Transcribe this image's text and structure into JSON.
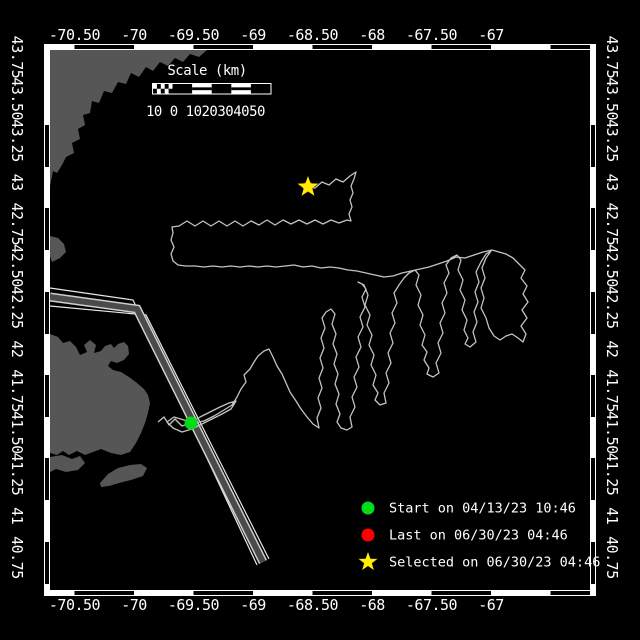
{
  "colors": {
    "background": "#000000",
    "land": "#565656",
    "track": "#c3c3c3",
    "frame": "#ffffff",
    "lane_band": "#4a4a4a",
    "lane_line": "#e8e8e8",
    "start_marker": "#00dd16",
    "last_marker": "#ff0000",
    "selected_marker": "#ffee00"
  },
  "axes": {
    "top_labels": [
      {
        "text": "-70.50",
        "x": 74.5
      },
      {
        "text": "-70",
        "x": 134
      },
      {
        "text": "-69.50",
        "x": 193.5
      },
      {
        "text": "-69",
        "x": 253
      },
      {
        "text": "-68.50",
        "x": 312.5
      },
      {
        "text": "-68",
        "x": 372
      },
      {
        "text": "-67.50",
        "x": 431.5
      },
      {
        "text": "-67",
        "x": 491
      }
    ],
    "side_labels": [
      {
        "text": "43.75",
        "y": 57
      },
      {
        "text": "43.50",
        "y": 98.7
      },
      {
        "text": "43.25",
        "y": 140.4
      },
      {
        "text": "43",
        "y": 182.1
      },
      {
        "text": "42.75",
        "y": 223.8
      },
      {
        "text": "42.50",
        "y": 265.5
      },
      {
        "text": "42.25",
        "y": 307.2
      },
      {
        "text": "42",
        "y": 348.9
      },
      {
        "text": "41.75",
        "y": 390.6
      },
      {
        "text": "41.50",
        "y": 432.3
      },
      {
        "text": "41.25",
        "y": 474
      },
      {
        "text": "41",
        "y": 515.7
      },
      {
        "text": "40.75",
        "y": 557.4
      }
    ],
    "top_baseline_y": 40,
    "bottom_baseline_y": 610,
    "left_anchor_x": 17,
    "right_anchor_x": 612
  },
  "frame": {
    "outer": [
      44,
      44,
      552,
      552
    ],
    "inner": [
      50,
      50,
      540,
      540
    ],
    "black_segments_x": [
      [
        74.5,
        134
      ],
      [
        193.5,
        253
      ],
      [
        312.5,
        372
      ],
      [
        431.5,
        491
      ],
      [
        550.5,
        590
      ]
    ],
    "black_segments_y": [
      [
        125,
        167
      ],
      [
        208,
        250
      ],
      [
        292,
        334
      ],
      [
        375,
        417
      ],
      [
        458,
        500
      ],
      [
        542,
        584
      ]
    ]
  },
  "scale_bar": {
    "title": "Scale (km)",
    "title_x": 207,
    "title_y": 75,
    "numbers": "10 0 1020304050",
    "numbers_x": 146,
    "numbers_y": 116,
    "bar": {
      "x": 153,
      "y": 84,
      "w": 117.5,
      "h": 9.5,
      "checker_w": 19.5,
      "segments": 5
    }
  },
  "legend": {
    "marker_x": 368,
    "text_x": 389,
    "rows_y": [
      508,
      535,
      562
    ],
    "items": [
      {
        "marker": "circle",
        "color": "#00dd16",
        "label": "Start on 04/13/23 10:46"
      },
      {
        "marker": "circle",
        "color": "#ff0000",
        "label": "Last on 06/30/23 04:46"
      },
      {
        "marker": "star",
        "color": "#ffee00",
        "label": "Selected on 06/30/23 04:46"
      }
    ]
  },
  "markers": {
    "start": {
      "x": 191,
      "y": 423,
      "r": 6.5
    },
    "last": {
      "x": 308,
      "y": 187,
      "r": 5.5
    },
    "selected": {
      "x": 308,
      "y": 187,
      "r_outer": 11,
      "r_inner": 4.4
    }
  },
  "land_polygons": [
    [
      [
        50,
        50
      ],
      [
        207,
        50
      ],
      [
        199,
        57
      ],
      [
        190,
        54
      ],
      [
        183,
        62
      ],
      [
        175,
        58
      ],
      [
        168,
        66
      ],
      [
        160,
        62
      ],
      [
        153,
        71
      ],
      [
        146,
        67
      ],
      [
        139,
        77
      ],
      [
        131,
        73
      ],
      [
        126,
        84
      ],
      [
        118,
        82
      ],
      [
        112,
        93
      ],
      [
        104,
        91
      ],
      [
        99,
        103
      ],
      [
        92,
        101
      ],
      [
        90,
        113
      ],
      [
        83,
        115
      ],
      [
        85,
        125
      ],
      [
        78,
        129
      ],
      [
        80,
        139
      ],
      [
        72,
        143
      ],
      [
        74,
        153
      ],
      [
        66,
        157
      ],
      [
        62,
        165
      ],
      [
        57,
        173
      ],
      [
        53,
        171
      ],
      [
        51,
        181
      ],
      [
        50,
        186
      ]
    ],
    [
      [
        50,
        236
      ],
      [
        58,
        238
      ],
      [
        64,
        244
      ],
      [
        66,
        252
      ],
      [
        60,
        258
      ],
      [
        52,
        262
      ],
      [
        50,
        256
      ]
    ],
    [
      [
        50,
        334
      ],
      [
        58,
        337
      ],
      [
        63,
        343
      ],
      [
        70,
        341
      ],
      [
        76,
        347
      ],
      [
        80,
        355
      ],
      [
        87,
        352
      ],
      [
        84,
        345
      ],
      [
        90,
        340
      ],
      [
        96,
        345
      ],
      [
        94,
        353
      ],
      [
        101,
        351
      ],
      [
        105,
        346
      ],
      [
        111,
        344
      ],
      [
        114,
        348
      ],
      [
        118,
        344
      ],
      [
        124,
        342
      ],
      [
        128,
        346
      ],
      [
        129,
        354
      ],
      [
        124,
        360
      ],
      [
        117,
        363
      ],
      [
        111,
        361
      ],
      [
        108,
        366
      ],
      [
        113,
        370
      ],
      [
        121,
        372
      ],
      [
        129,
        377
      ],
      [
        137,
        383
      ],
      [
        144,
        389
      ],
      [
        148,
        395
      ],
      [
        150,
        403
      ],
      [
        148,
        413
      ],
      [
        145,
        423
      ],
      [
        141,
        433
      ],
      [
        136,
        443
      ],
      [
        130,
        452
      ],
      [
        121,
        455
      ],
      [
        111,
        453
      ],
      [
        101,
        449
      ],
      [
        93,
        452
      ],
      [
        85,
        455
      ],
      [
        77,
        451
      ],
      [
        69,
        455
      ],
      [
        63,
        451
      ],
      [
        57,
        455
      ],
      [
        50,
        453
      ]
    ],
    [
      [
        50,
        457
      ],
      [
        62,
        455
      ],
      [
        72,
        459
      ],
      [
        80,
        456
      ],
      [
        85,
        463
      ],
      [
        78,
        470
      ],
      [
        66,
        472
      ],
      [
        56,
        469
      ],
      [
        50,
        472
      ]
    ],
    [
      [
        100,
        483
      ],
      [
        108,
        474
      ],
      [
        118,
        468
      ],
      [
        130,
        465
      ],
      [
        141,
        464
      ],
      [
        147,
        468
      ],
      [
        143,
        476
      ],
      [
        131,
        480
      ],
      [
        119,
        483
      ],
      [
        109,
        486
      ],
      [
        101,
        487
      ]
    ]
  ],
  "shipping_lane": {
    "west_line": [
      [
        50,
        288
      ],
      [
        133,
        300
      ],
      [
        257,
        565
      ]
    ],
    "center_band": [
      [
        50,
        297
      ],
      [
        137,
        309
      ],
      [
        263,
        562
      ]
    ],
    "east_line": [
      [
        50,
        306
      ],
      [
        146,
        315
      ],
      [
        269,
        559
      ]
    ],
    "band_width": 6,
    "edge_width": 9,
    "line_width": 1.2
  },
  "track_points": [
    [
      158,
      422
    ],
    [
      164,
      417
    ],
    [
      169,
      425
    ],
    [
      175,
      419
    ],
    [
      182,
      426
    ],
    [
      191,
      423
    ],
    [
      200,
      417
    ],
    [
      210,
      412
    ],
    [
      220,
      407
    ],
    [
      229,
      403
    ],
    [
      236,
      401
    ],
    [
      231,
      409
    ],
    [
      222,
      414
    ],
    [
      212,
      419
    ],
    [
      202,
      424
    ],
    [
      192,
      429
    ],
    [
      182,
      432
    ],
    [
      173,
      428
    ],
    [
      167,
      422
    ],
    [
      174,
      417
    ],
    [
      184,
      420
    ],
    [
      194,
      423
    ],
    [
      204,
      421
    ],
    [
      214,
      416
    ],
    [
      224,
      410
    ],
    [
      232,
      405
    ],
    [
      237,
      397
    ],
    [
      241,
      389
    ],
    [
      246,
      382
    ],
    [
      244,
      375
    ],
    [
      250,
      369
    ],
    [
      254,
      362
    ],
    [
      258,
      356
    ],
    [
      264,
      351
    ],
    [
      269,
      349
    ],
    [
      273,
      357
    ],
    [
      277,
      366
    ],
    [
      282,
      374
    ],
    [
      286,
      383
    ],
    [
      290,
      392
    ],
    [
      296,
      401
    ],
    [
      301,
      409
    ],
    [
      307,
      417
    ],
    [
      313,
      424
    ],
    [
      319,
      428
    ],
    [
      317,
      418
    ],
    [
      321,
      408
    ],
    [
      318,
      398
    ],
    [
      322,
      388
    ],
    [
      319,
      378
    ],
    [
      323,
      368
    ],
    [
      320,
      358
    ],
    [
      324,
      348
    ],
    [
      321,
      338
    ],
    [
      325,
      328
    ],
    [
      322,
      318
    ],
    [
      326,
      312
    ],
    [
      331,
      309
    ],
    [
      335,
      314
    ],
    [
      332,
      324
    ],
    [
      336,
      334
    ],
    [
      333,
      344
    ],
    [
      337,
      354
    ],
    [
      334,
      364
    ],
    [
      338,
      374
    ],
    [
      335,
      384
    ],
    [
      339,
      394
    ],
    [
      336,
      404
    ],
    [
      340,
      414
    ],
    [
      337,
      422
    ],
    [
      341,
      428
    ],
    [
      347,
      430
    ],
    [
      352,
      427
    ],
    [
      350,
      417
    ],
    [
      355,
      407
    ],
    [
      352,
      397
    ],
    [
      357,
      387
    ],
    [
      354,
      377
    ],
    [
      359,
      367
    ],
    [
      356,
      357
    ],
    [
      361,
      347
    ],
    [
      358,
      337
    ],
    [
      363,
      327
    ],
    [
      360,
      317
    ],
    [
      365,
      307
    ],
    [
      362,
      297
    ],
    [
      366,
      289
    ],
    [
      362,
      284
    ],
    [
      358,
      282
    ],
    [
      364,
      285
    ],
    [
      368,
      295
    ],
    [
      365,
      305
    ],
    [
      370,
      315
    ],
    [
      367,
      325
    ],
    [
      372,
      335
    ],
    [
      369,
      345
    ],
    [
      374,
      355
    ],
    [
      371,
      365
    ],
    [
      376,
      375
    ],
    [
      373,
      385
    ],
    [
      378,
      393
    ],
    [
      375,
      400
    ],
    [
      380,
      405
    ],
    [
      386,
      403
    ],
    [
      384,
      393
    ],
    [
      389,
      383
    ],
    [
      386,
      373
    ],
    [
      391,
      363
    ],
    [
      388,
      353
    ],
    [
      393,
      343
    ],
    [
      390,
      333
    ],
    [
      395,
      323
    ],
    [
      392,
      313
    ],
    [
      397,
      303
    ],
    [
      394,
      293
    ],
    [
      399,
      285
    ],
    [
      404,
      278
    ],
    [
      409,
      273
    ],
    [
      415,
      270
    ],
    [
      419,
      275
    ],
    [
      416,
      285
    ],
    [
      421,
      295
    ],
    [
      418,
      305
    ],
    [
      423,
      315
    ],
    [
      420,
      325
    ],
    [
      425,
      335
    ],
    [
      422,
      345
    ],
    [
      427,
      352
    ],
    [
      424,
      360
    ],
    [
      429,
      368
    ],
    [
      427,
      374
    ],
    [
      433,
      377
    ],
    [
      439,
      373
    ],
    [
      436,
      363
    ],
    [
      441,
      353
    ],
    [
      438,
      343
    ],
    [
      443,
      333
    ],
    [
      440,
      323
    ],
    [
      445,
      313
    ],
    [
      442,
      303
    ],
    [
      447,
      293
    ],
    [
      444,
      283
    ],
    [
      449,
      273
    ],
    [
      446,
      265
    ],
    [
      451,
      258
    ],
    [
      457,
      255
    ],
    [
      461,
      260
    ],
    [
      458,
      270
    ],
    [
      463,
      280
    ],
    [
      460,
      290
    ],
    [
      465,
      300
    ],
    [
      462,
      310
    ],
    [
      467,
      320
    ],
    [
      464,
      330
    ],
    [
      468,
      338
    ],
    [
      465,
      344
    ],
    [
      470,
      347
    ],
    [
      476,
      342
    ],
    [
      473,
      332
    ],
    [
      477,
      322
    ],
    [
      474,
      312
    ],
    [
      478,
      302
    ],
    [
      475,
      292
    ],
    [
      479,
      282
    ],
    [
      476,
      272
    ],
    [
      481,
      262
    ],
    [
      486,
      254
    ],
    [
      491,
      251
    ],
    [
      486,
      258
    ],
    [
      482,
      268
    ],
    [
      485,
      278
    ],
    [
      481,
      288
    ],
    [
      484,
      298
    ],
    [
      481,
      308
    ],
    [
      486,
      318
    ],
    [
      489,
      328
    ],
    [
      494,
      336
    ],
    [
      500,
      340
    ],
    [
      506,
      336
    ],
    [
      512,
      334
    ],
    [
      518,
      338
    ],
    [
      523,
      342
    ],
    [
      526,
      334
    ],
    [
      521,
      326
    ],
    [
      527,
      318
    ],
    [
      522,
      310
    ],
    [
      528,
      302
    ],
    [
      523,
      294
    ],
    [
      527,
      286
    ],
    [
      521,
      278
    ],
    [
      525,
      270
    ],
    [
      519,
      264
    ],
    [
      513,
      258
    ],
    [
      506,
      254
    ],
    [
      499,
      252
    ],
    [
      492,
      250
    ],
    [
      483,
      252
    ],
    [
      474,
      255
    ],
    [
      465,
      258
    ],
    [
      456,
      257
    ],
    [
      447,
      261
    ],
    [
      438,
      264
    ],
    [
      429,
      267
    ],
    [
      420,
      269
    ],
    [
      411,
      271
    ],
    [
      402,
      273
    ],
    [
      393,
      276
    ],
    [
      384,
      277
    ],
    [
      375,
      275
    ],
    [
      366,
      273
    ],
    [
      357,
      271
    ],
    [
      348,
      270
    ],
    [
      339,
      268
    ],
    [
      330,
      267
    ],
    [
      321,
      268
    ],
    [
      312,
      266
    ],
    [
      303,
      267
    ],
    [
      294,
      265
    ],
    [
      285,
      266
    ],
    [
      276,
      267
    ],
    [
      267,
      266
    ],
    [
      258,
      267
    ],
    [
      249,
      266
    ],
    [
      240,
      267
    ],
    [
      231,
      266
    ],
    [
      222,
      267
    ],
    [
      213,
      266
    ],
    [
      204,
      267
    ],
    [
      195,
      266
    ],
    [
      186,
      266
    ],
    [
      178,
      265
    ],
    [
      173,
      261
    ],
    [
      171,
      254
    ],
    [
      174,
      247
    ],
    [
      171,
      240
    ],
    [
      173,
      233
    ],
    [
      172,
      227
    ],
    [
      179,
      226
    ],
    [
      187,
      221
    ],
    [
      195,
      226
    ],
    [
      203,
      221
    ],
    [
      211,
      226
    ],
    [
      219,
      221
    ],
    [
      227,
      226
    ],
    [
      235,
      221
    ],
    [
      243,
      226
    ],
    [
      251,
      221
    ],
    [
      259,
      225
    ],
    [
      267,
      220
    ],
    [
      275,
      225
    ],
    [
      283,
      220
    ],
    [
      291,
      224
    ],
    [
      299,
      220
    ],
    [
      307,
      224
    ],
    [
      315,
      220
    ],
    [
      323,
      224
    ],
    [
      331,
      220
    ],
    [
      339,
      223
    ],
    [
      347,
      220
    ],
    [
      351,
      221
    ],
    [
      349,
      214
    ],
    [
      352,
      207
    ],
    [
      350,
      200
    ],
    [
      353,
      193
    ],
    [
      351,
      186
    ],
    [
      354,
      179
    ],
    [
      356,
      172
    ],
    [
      350,
      176
    ],
    [
      343,
      182
    ],
    [
      336,
      179
    ],
    [
      329,
      185
    ],
    [
      322,
      182
    ],
    [
      315,
      188
    ],
    [
      308,
      187
    ]
  ]
}
